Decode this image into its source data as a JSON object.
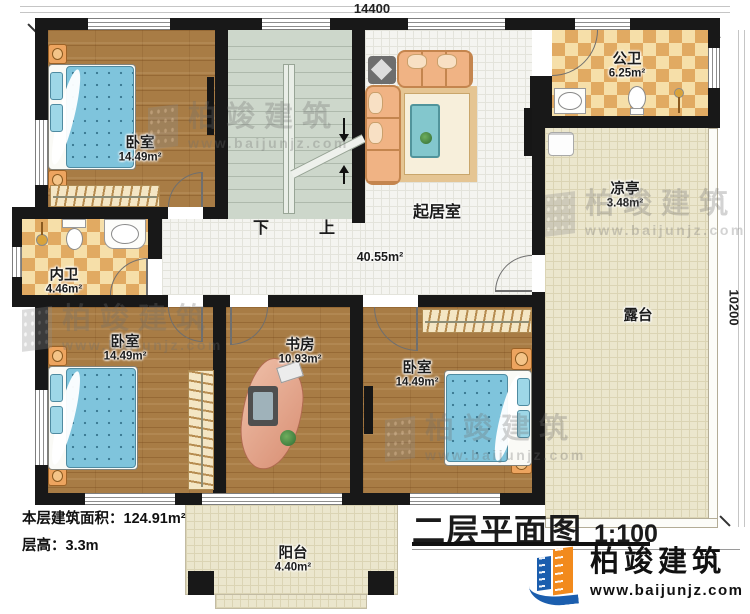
{
  "drawing": {
    "title": "二层平面图",
    "scale": "1:100",
    "stats_area_line": "本层建筑面积：124.91m²",
    "stats_height_line": "层高：3.3m"
  },
  "dimensions": {
    "width_label": "14400",
    "height_label": "10200"
  },
  "rooms": {
    "bedroom_tl": {
      "name": "卧室",
      "area": "14.49m²"
    },
    "bedroom_bl": {
      "name": "卧室",
      "area": "14.49m²"
    },
    "bedroom_bm": {
      "name": "卧室",
      "area": "14.49m²"
    },
    "public_bath": {
      "name": "公卫",
      "area": "6.25m²"
    },
    "inner_bath": {
      "name": "内卫",
      "area": "4.46m²"
    },
    "living": {
      "name": "起居室",
      "area": "40.55m²"
    },
    "study": {
      "name": "书房",
      "area": "10.93m²"
    },
    "pavilion": {
      "name": "凉亭",
      "area": "3.48m²"
    },
    "terrace": {
      "name": "露台"
    },
    "balcony": {
      "name": "阳台",
      "area": "4.40m²"
    }
  },
  "stairs": {
    "down_label": "下",
    "up_label": "上"
  },
  "brand": {
    "name": "柏竣建筑",
    "website": "www.baijunjz.com"
  },
  "colors": {
    "wall": "#181818",
    "wood_floor": "#a87c45",
    "tile_floor": "#f4f4f0",
    "checker_floor": "#e1aa62",
    "outdoor_floor": "#ebe6cd",
    "stair_floor": "#cdd7cb",
    "bed_blanket": "#7fc4dc",
    "sofa": "#f0b384",
    "logo_blue": "#1b5eae",
    "logo_orange": "#f28a1d"
  }
}
